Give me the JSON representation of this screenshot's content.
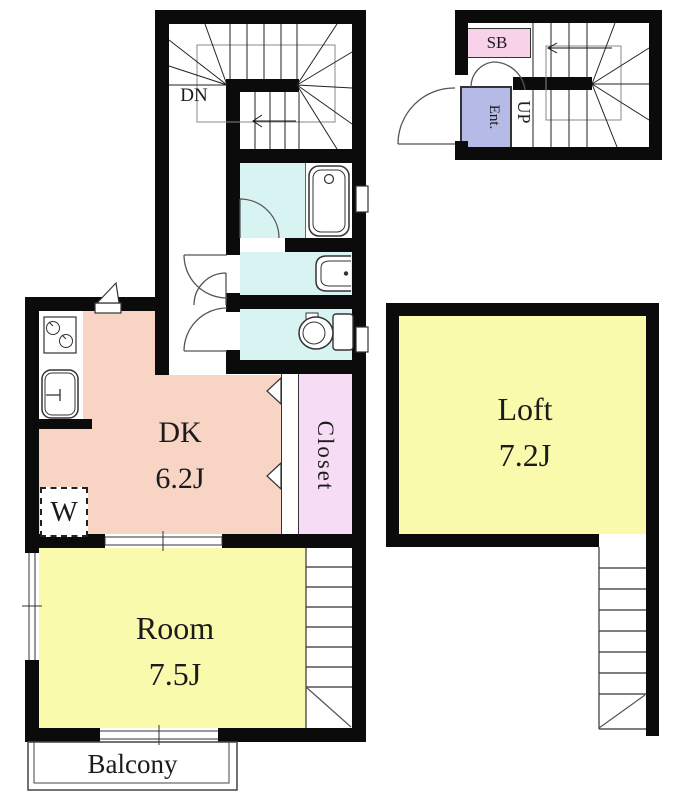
{
  "plan": {
    "second_floor": {
      "stairs_direction": "DN",
      "dk_name": "DK",
      "dk_area": "6.2J",
      "closet": "Closet",
      "washer": "W",
      "room_name": "Room",
      "room_area": "7.5J",
      "balcony": "Balcony"
    },
    "loft": {
      "name": "Loft",
      "area": "7.2J"
    },
    "first_floor": {
      "shoe_box": "SB",
      "entrance": "Ent.",
      "stairs_direction": "UP"
    }
  },
  "colors": {
    "wall": "#0b0b0b",
    "dk": "#f8d4c5",
    "room": "#fafaad",
    "loft": "#fafaad",
    "bathroom": "#d8f4f2",
    "closet": "#f6dcf4",
    "shoe_box": "#f8d2e9",
    "entrance": "#b6bae6"
  }
}
